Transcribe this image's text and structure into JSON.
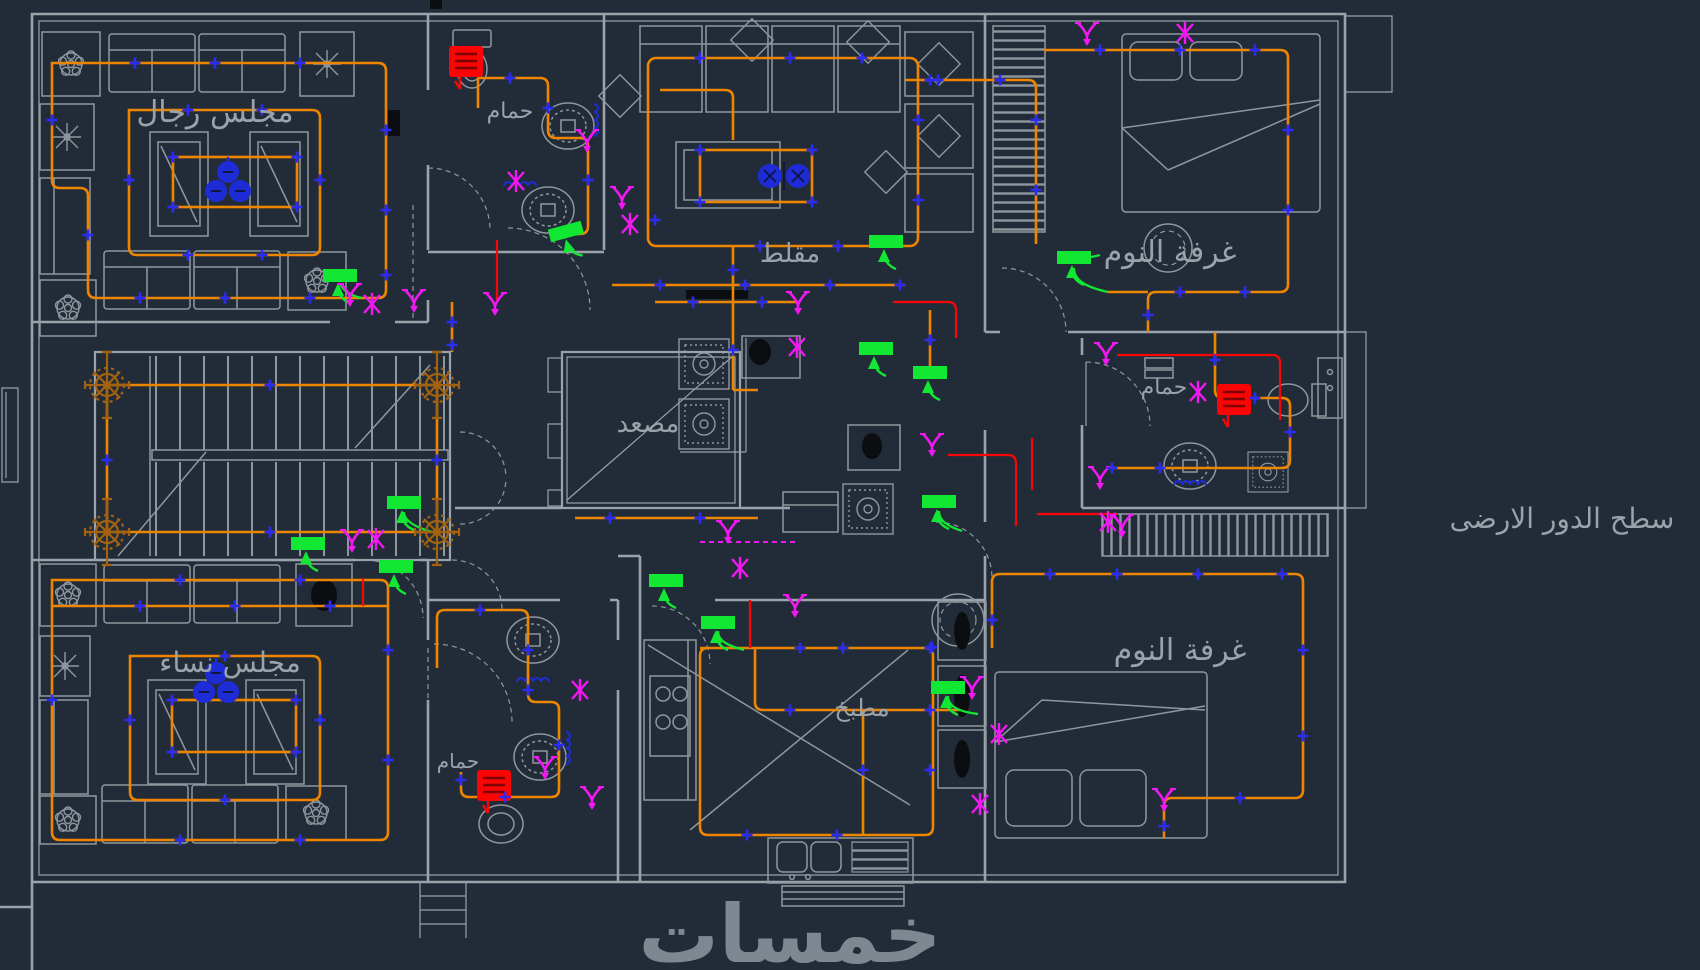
{
  "drawing": {
    "background": "#222c38",
    "caption": "سطح الدور الارضى",
    "watermark": "خمسات",
    "rooms": {
      "majlis_men": "مجلس رجال",
      "bathroom_top": "حمام",
      "muqallat": "مقلط",
      "bedroom_top": "غرفة النوم",
      "elevator": "مصعد",
      "bathroom_right": "حمام",
      "majlis_women": "مجلس نساء",
      "bathroom_bottom": "حمام",
      "kitchen": "مطبخ",
      "bedroom_bottom": "غرفة النوم"
    },
    "colors": {
      "walls_furniture": "#9aa2aa",
      "wiring": "#ee8500",
      "junction_marker": "#2a2cf5",
      "switch": "#12e833",
      "light_fixture": "#f318f3",
      "exhaust_fan": "#fa0505",
      "chandelier": "#a2620f",
      "text": "#9aa2aa",
      "watermark": "#858d96"
    },
    "symbols": {
      "junction_marker": "blue-cross",
      "ceiling_fan": "blue-filled-circles",
      "wall_switch": "green-bar-with-arrow",
      "light_point": "magenta-glyph",
      "exhaust_fan": "red-hatched-box",
      "stair_chandelier": "brown-ornament"
    }
  }
}
